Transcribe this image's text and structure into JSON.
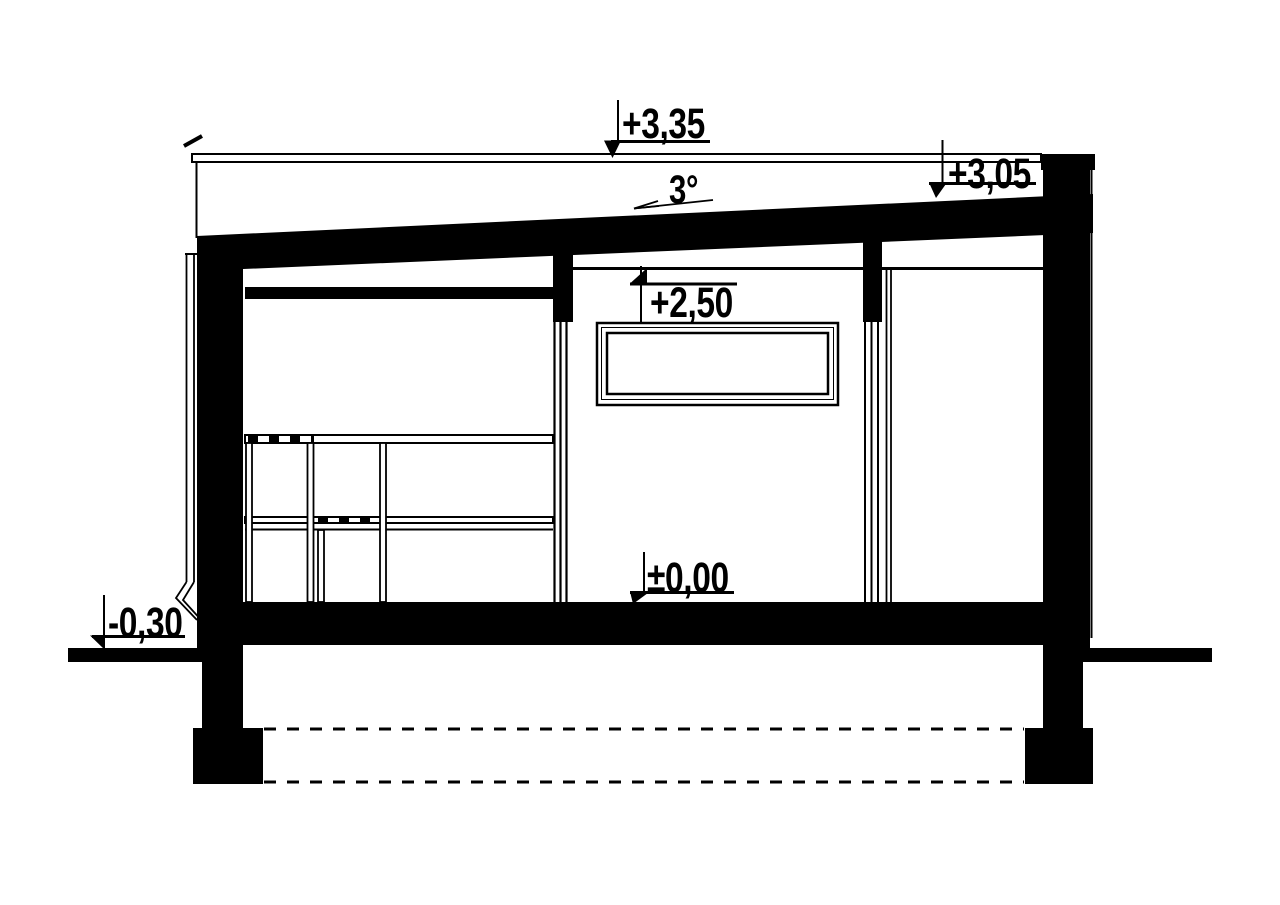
{
  "document": {
    "type": "architectural cross-section drawing",
    "paper_color": "#ffffff",
    "ink_color": "#000000"
  },
  "annotations": {
    "levels": [
      {
        "name": "attic-top",
        "label": "+3,35"
      },
      {
        "name": "roof-edge",
        "label": "+3,05"
      },
      {
        "name": "ceiling",
        "label": "+2,50"
      },
      {
        "name": "finished-floor",
        "label": "±0,00"
      },
      {
        "name": "exterior-grade",
        "label": "-0,30"
      }
    ],
    "roof_slope_label": "3°"
  }
}
